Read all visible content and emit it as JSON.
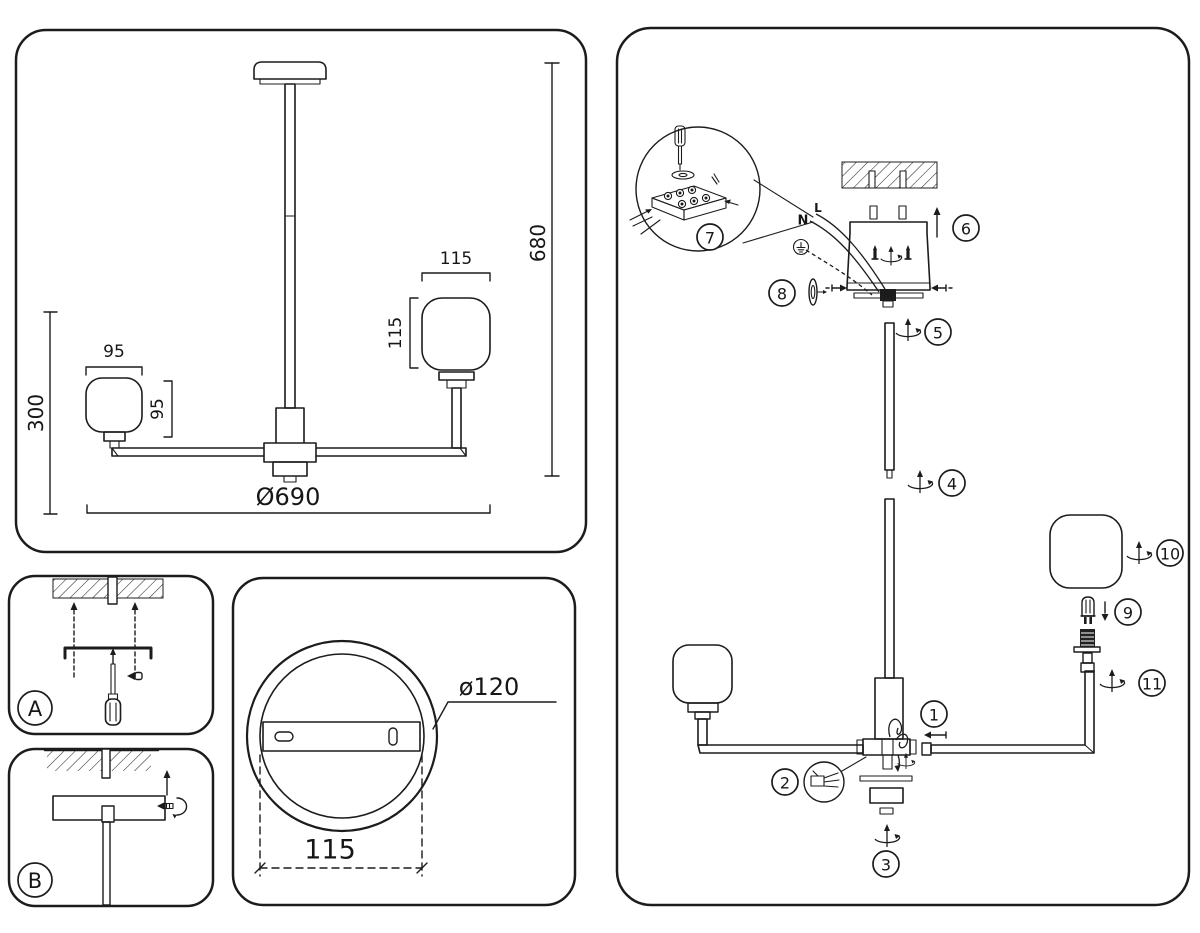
{
  "front_view": {
    "height": "680",
    "diameter": "Ø690",
    "drop": "300",
    "left_shade_width": "95",
    "left_shade_height": "95",
    "right_shade_width": "115",
    "right_shade_height": "115"
  },
  "canopy_view": {
    "diameter": "ø120",
    "hole_spacing": "115"
  },
  "panel_a": {
    "label": "A"
  },
  "panel_b": {
    "label": "B"
  },
  "assembly": {
    "wire_live": "L",
    "wire_neutral": "N",
    "steps": {
      "s1": "1",
      "s2": "2",
      "s3": "3",
      "s4": "4",
      "s5": "5",
      "s6": "6",
      "s7": "7",
      "s8": "8",
      "s9": "9",
      "s10": "10",
      "s11": "11"
    }
  }
}
